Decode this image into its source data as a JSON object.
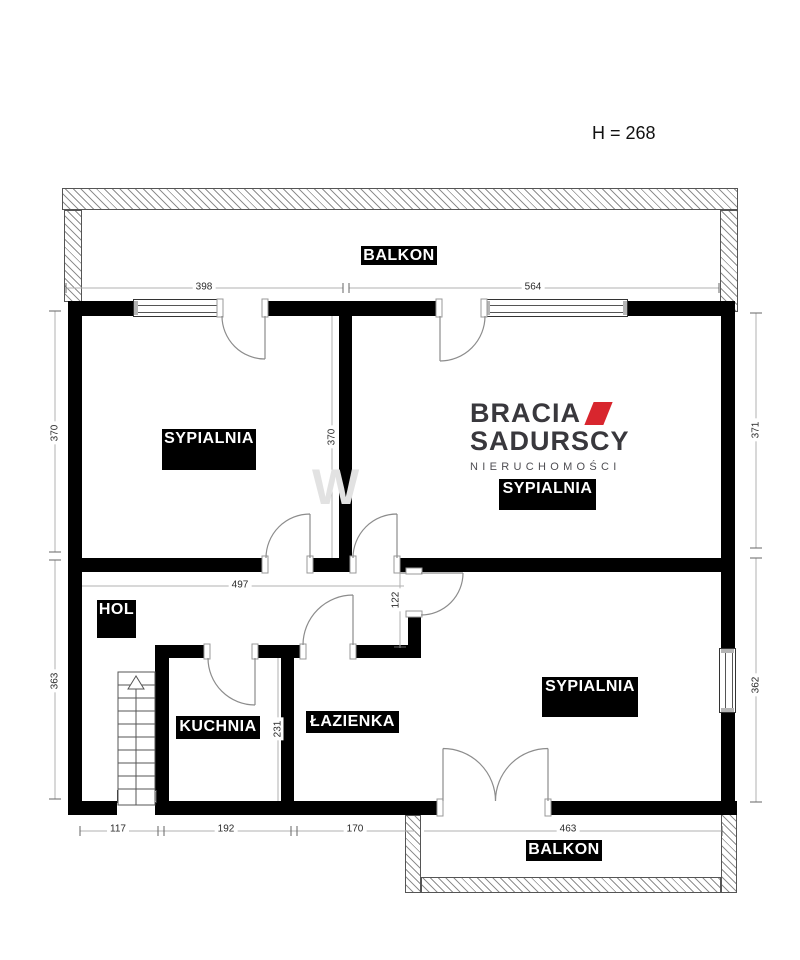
{
  "header": {
    "ceiling_height": "H = 268"
  },
  "logo": {
    "line1": "BRACIA",
    "line2": "SADURSCY",
    "tagline": "NIERUCHOMOŚCI",
    "accent_color": "#d8262e",
    "text_color": "#39383d"
  },
  "rooms": {
    "bedroom_left": "SYPIALNIA",
    "bedroom_right": "SYPIALNIA",
    "bedroom_bottom": "SYPIALNIA",
    "hall": "HOL",
    "kitchen": "KUCHNIA",
    "bathroom": "ŁAZIENKA",
    "balcony_top": "BALKON",
    "balcony_bottom": "BALKON"
  },
  "dims": {
    "balcony_top_left": "398",
    "balcony_top_right": "564",
    "bedroom_left_depth": "370",
    "bedroom_mid_depth": "370",
    "bedroom_right_depth": "371",
    "hall_width": "497",
    "passage_depth": "122",
    "lower_left_depth": "363",
    "kitchen_depth": "231",
    "bedroom_bottom_depth": "362",
    "bottom_seg1": "117",
    "bottom_seg2": "192",
    "bottom_seg3": "170",
    "bottom_balcony": "463"
  },
  "watermark": "W"
}
